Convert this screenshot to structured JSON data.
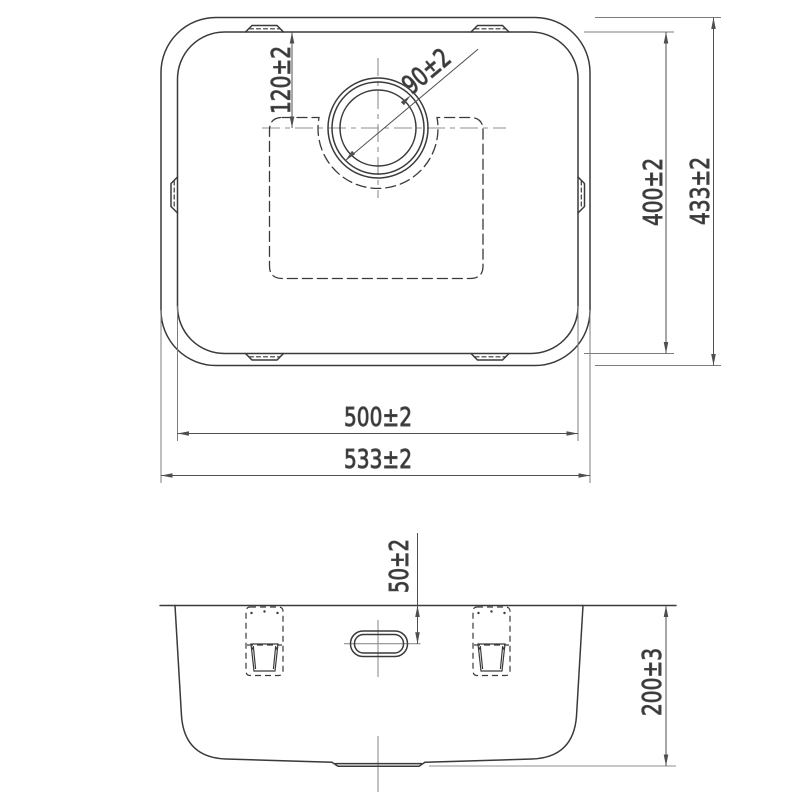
{
  "colors": {
    "line": "#3a3a3a",
    "dim": "#4f4f4f",
    "centerline": "#8f8f8f",
    "text": "#333333",
    "background": "#ffffff"
  },
  "top_view": {
    "bowl_width_label": "500±2",
    "overall_width_label": "533±2",
    "bowl_length_label": "400±2",
    "overall_length_label": "433±2",
    "drain_center_offset_label": "120±2",
    "drain_diameter_label": "90±2"
  },
  "side_view": {
    "overflow_offset_label": "50±2",
    "depth_label": "200±3"
  }
}
